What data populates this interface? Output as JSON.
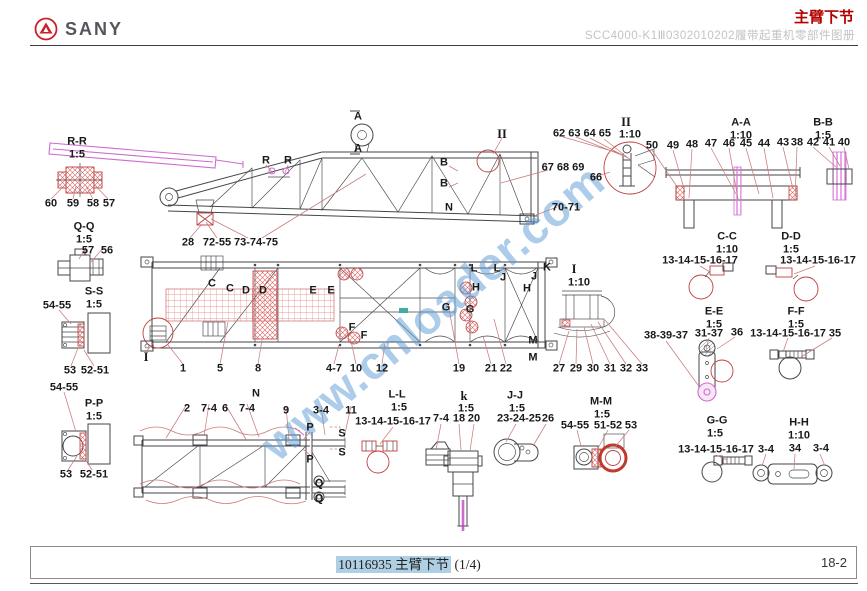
{
  "header": {
    "brand": "SANY",
    "page_title": "主臂下节",
    "subtitle": "SCC4000-K1Ⅲ0302010202履带起重机零部件图册"
  },
  "watermark": {
    "text": "www.cnloader.com"
  },
  "footer": {
    "doc_code": "10116935",
    "doc_title": "主臂下节",
    "page_fraction": "(1/4)",
    "page_number": "18-2"
  },
  "colors": {
    "accent": "#b30000",
    "magenta": "#cf6bcf",
    "watermark": "#5b9bd5",
    "hatch-red": "#d94f4f",
    "highlight": "#aecfe4",
    "leader": "#c97c7c",
    "line": "#45464a"
  },
  "diagram": {
    "callouts": [
      {
        "t": "R-R",
        "x": 77,
        "y": 142
      },
      {
        "t": "1:5",
        "x": 77,
        "y": 155
      },
      {
        "t": "60",
        "x": 51,
        "y": 204
      },
      {
        "t": "59",
        "x": 73,
        "y": 204
      },
      {
        "t": "58",
        "x": 93,
        "y": 204
      },
      {
        "t": "57",
        "x": 109,
        "y": 204
      },
      {
        "t": "Q-Q",
        "x": 84,
        "y": 227
      },
      {
        "t": "1:5",
        "x": 84,
        "y": 240
      },
      {
        "t": "57",
        "x": 88,
        "y": 251
      },
      {
        "t": "56",
        "x": 107,
        "y": 251
      },
      {
        "t": "S-S",
        "x": 94,
        "y": 292
      },
      {
        "t": "1:5",
        "x": 94,
        "y": 305
      },
      {
        "t": "54-55",
        "x": 57,
        "y": 306
      },
      {
        "t": "53",
        "x": 70,
        "y": 371
      },
      {
        "t": "52-51",
        "x": 95,
        "y": 371
      },
      {
        "t": "54-55",
        "x": 64,
        "y": 388
      },
      {
        "t": "P-P",
        "x": 94,
        "y": 404
      },
      {
        "t": "1:5",
        "x": 94,
        "y": 417
      },
      {
        "t": "53",
        "x": 66,
        "y": 475
      },
      {
        "t": "52-51",
        "x": 94,
        "y": 475
      },
      {
        "t": "I",
        "x": 146,
        "y": 357,
        "cls": "rm"
      },
      {
        "t": "A",
        "x": 358,
        "y": 117
      },
      {
        "t": "A",
        "x": 358,
        "y": 149
      },
      {
        "t": "R",
        "x": 266,
        "y": 161
      },
      {
        "t": "R",
        "x": 288,
        "y": 161
      },
      {
        "t": "II",
        "x": 502,
        "y": 134,
        "cls": "rm"
      },
      {
        "t": "B",
        "x": 444,
        "y": 163
      },
      {
        "t": "B",
        "x": 444,
        "y": 184
      },
      {
        "t": "N",
        "x": 449,
        "y": 208
      },
      {
        "t": "28",
        "x": 188,
        "y": 243
      },
      {
        "t": "72-55",
        "x": 217,
        "y": 243
      },
      {
        "t": "73-74-75",
        "x": 256,
        "y": 243
      },
      {
        "t": "62 63 64 65",
        "x": 582,
        "y": 134
      },
      {
        "t": "II",
        "x": 626,
        "y": 122,
        "cls": "rm"
      },
      {
        "t": "1:10",
        "x": 630,
        "y": 135
      },
      {
        "t": "67 68 69",
        "x": 563,
        "y": 168
      },
      {
        "t": "66",
        "x": 596,
        "y": 178
      },
      {
        "t": "70-71",
        "x": 566,
        "y": 208
      },
      {
        "t": "A-A",
        "x": 741,
        "y": 123
      },
      {
        "t": "1:10",
        "x": 741,
        "y": 136
      },
      {
        "t": "B-B",
        "x": 823,
        "y": 123
      },
      {
        "t": "1:5",
        "x": 823,
        "y": 136
      },
      {
        "t": "50",
        "x": 652,
        "y": 146
      },
      {
        "t": "49",
        "x": 673,
        "y": 146
      },
      {
        "t": "48",
        "x": 692,
        "y": 145
      },
      {
        "t": "47",
        "x": 711,
        "y": 144
      },
      {
        "t": "46",
        "x": 729,
        "y": 144
      },
      {
        "t": "45",
        "x": 746,
        "y": 144
      },
      {
        "t": "44",
        "x": 764,
        "y": 144
      },
      {
        "t": "43",
        "x": 783,
        "y": 143
      },
      {
        "t": "38",
        "x": 797,
        "y": 143
      },
      {
        "t": "42",
        "x": 813,
        "y": 143
      },
      {
        "t": "41",
        "x": 829,
        "y": 143
      },
      {
        "t": "40",
        "x": 844,
        "y": 143
      },
      {
        "t": "C-C",
        "x": 727,
        "y": 237
      },
      {
        "t": "1:10",
        "x": 727,
        "y": 250
      },
      {
        "t": "13-14-15-16-17",
        "x": 700,
        "y": 261
      },
      {
        "t": "D-D",
        "x": 791,
        "y": 237
      },
      {
        "t": "1:5",
        "x": 791,
        "y": 250
      },
      {
        "t": "13-14-15-16-17",
        "x": 818,
        "y": 261
      },
      {
        "t": "E-E",
        "x": 714,
        "y": 312
      },
      {
        "t": "1:5",
        "x": 714,
        "y": 325
      },
      {
        "t": "38-39-37",
        "x": 666,
        "y": 336
      },
      {
        "t": "31-37",
        "x": 709,
        "y": 334
      },
      {
        "t": "36",
        "x": 737,
        "y": 333
      },
      {
        "t": "F-F",
        "x": 796,
        "y": 312
      },
      {
        "t": "1:5",
        "x": 796,
        "y": 325
      },
      {
        "t": "13-14-15-16-17",
        "x": 788,
        "y": 334
      },
      {
        "t": "35",
        "x": 835,
        "y": 334
      },
      {
        "t": "G-G",
        "x": 717,
        "y": 421
      },
      {
        "t": "1:5",
        "x": 715,
        "y": 434
      },
      {
        "t": "13-14-15-16-17",
        "x": 716,
        "y": 450
      },
      {
        "t": "H-H",
        "x": 799,
        "y": 423
      },
      {
        "t": "1:10",
        "x": 799,
        "y": 436
      },
      {
        "t": "3-4",
        "x": 766,
        "y": 450
      },
      {
        "t": "34",
        "x": 795,
        "y": 449
      },
      {
        "t": "3-4",
        "x": 821,
        "y": 449
      },
      {
        "t": "C",
        "x": 212,
        "y": 284
      },
      {
        "t": "C",
        "x": 230,
        "y": 289
      },
      {
        "t": "D",
        "x": 246,
        "y": 291
      },
      {
        "t": "D",
        "x": 263,
        "y": 291
      },
      {
        "t": "E",
        "x": 313,
        "y": 291
      },
      {
        "t": "E",
        "x": 331,
        "y": 291
      },
      {
        "t": "L",
        "x": 474,
        "y": 269
      },
      {
        "t": "L",
        "x": 497,
        "y": 269
      },
      {
        "t": "J",
        "x": 503,
        "y": 278
      },
      {
        "t": "J",
        "x": 534,
        "y": 277
      },
      {
        "t": "K",
        "x": 547,
        "y": 268
      },
      {
        "t": "H",
        "x": 476,
        "y": 288
      },
      {
        "t": "H",
        "x": 527,
        "y": 289
      },
      {
        "t": "G",
        "x": 446,
        "y": 308
      },
      {
        "t": "G",
        "x": 470,
        "y": 310
      },
      {
        "t": "F",
        "x": 352,
        "y": 328
      },
      {
        "t": "F",
        "x": 364,
        "y": 336
      },
      {
        "t": "M",
        "x": 533,
        "y": 341
      },
      {
        "t": "M",
        "x": 533,
        "y": 358
      },
      {
        "t": "1",
        "x": 183,
        "y": 369
      },
      {
        "t": "5",
        "x": 220,
        "y": 369
      },
      {
        "t": "8",
        "x": 258,
        "y": 369
      },
      {
        "t": "4-7",
        "x": 334,
        "y": 369
      },
      {
        "t": "10",
        "x": 356,
        "y": 369
      },
      {
        "t": "12",
        "x": 382,
        "y": 369
      },
      {
        "t": "19",
        "x": 459,
        "y": 369
      },
      {
        "t": "21",
        "x": 491,
        "y": 369
      },
      {
        "t": "22",
        "x": 506,
        "y": 369
      },
      {
        "t": "I",
        "x": 574,
        "y": 269,
        "cls": "rm"
      },
      {
        "t": "1:10",
        "x": 579,
        "y": 283
      },
      {
        "t": "27",
        "x": 559,
        "y": 369
      },
      {
        "t": "29",
        "x": 576,
        "y": 369
      },
      {
        "t": "30",
        "x": 593,
        "y": 369
      },
      {
        "t": "31",
        "x": 610,
        "y": 369
      },
      {
        "t": "32",
        "x": 626,
        "y": 369
      },
      {
        "t": "33",
        "x": 642,
        "y": 369
      },
      {
        "t": "N",
        "x": 256,
        "y": 394
      },
      {
        "t": "2",
        "x": 187,
        "y": 409
      },
      {
        "t": "7-4",
        "x": 209,
        "y": 409
      },
      {
        "t": "6",
        "x": 225,
        "y": 409
      },
      {
        "t": "7-4",
        "x": 247,
        "y": 409
      },
      {
        "t": "9",
        "x": 286,
        "y": 411
      },
      {
        "t": "3-4",
        "x": 321,
        "y": 411
      },
      {
        "t": "11",
        "x": 351,
        "y": 411
      },
      {
        "t": "P",
        "x": 310,
        "y": 428
      },
      {
        "t": "S",
        "x": 342,
        "y": 434
      },
      {
        "t": "P",
        "x": 310,
        "y": 460
      },
      {
        "t": "S",
        "x": 342,
        "y": 453
      },
      {
        "t": "Q",
        "x": 319,
        "y": 484
      },
      {
        "t": "Q",
        "x": 319,
        "y": 499
      },
      {
        "t": "L-L",
        "x": 397,
        "y": 395
      },
      {
        "t": "1:5",
        "x": 399,
        "y": 408
      },
      {
        "t": "13-14-15-16-17",
        "x": 393,
        "y": 422
      },
      {
        "t": "k",
        "x": 464,
        "y": 396,
        "cls": "rm"
      },
      {
        "t": "1:5",
        "x": 466,
        "y": 409
      },
      {
        "t": "7-4",
        "x": 441,
        "y": 419
      },
      {
        "t": "18",
        "x": 459,
        "y": 419
      },
      {
        "t": "20",
        "x": 474,
        "y": 419
      },
      {
        "t": "J-J",
        "x": 515,
        "y": 396
      },
      {
        "t": "1:5",
        "x": 517,
        "y": 409
      },
      {
        "t": "23-24-25",
        "x": 519,
        "y": 419
      },
      {
        "t": "26",
        "x": 548,
        "y": 419
      },
      {
        "t": "M-M",
        "x": 601,
        "y": 402
      },
      {
        "t": "1:5",
        "x": 602,
        "y": 415
      },
      {
        "t": "54-55",
        "x": 575,
        "y": 426
      },
      {
        "t": "51-52",
        "x": 608,
        "y": 426
      },
      {
        "t": "53",
        "x": 631,
        "y": 426
      }
    ]
  }
}
